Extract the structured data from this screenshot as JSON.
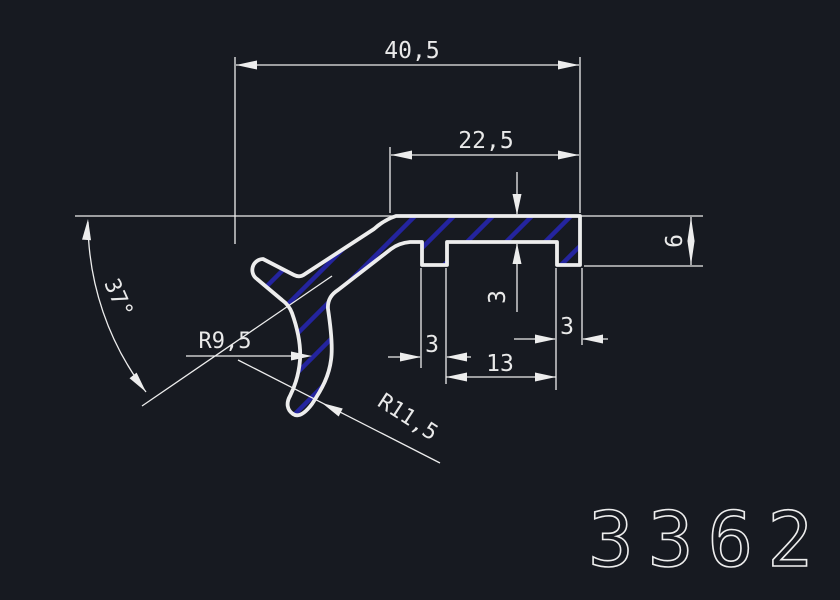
{
  "drawing": {
    "profile_number": "3362",
    "dims": {
      "overall_width": "40,5",
      "upper_flange_width": "22,5",
      "right_end_height": "6",
      "wall_thickness": "3",
      "left_tooth_width": "3",
      "tooth_spacing": "13",
      "right_tooth_width": "3",
      "arm_angle": "37°",
      "radius_inner": "R9,5",
      "radius_outer": "R11,5"
    },
    "colors": {
      "background": "#171a21",
      "line": "#ededed",
      "text": "#e9e9e9",
      "hatch": "#24249e"
    }
  }
}
